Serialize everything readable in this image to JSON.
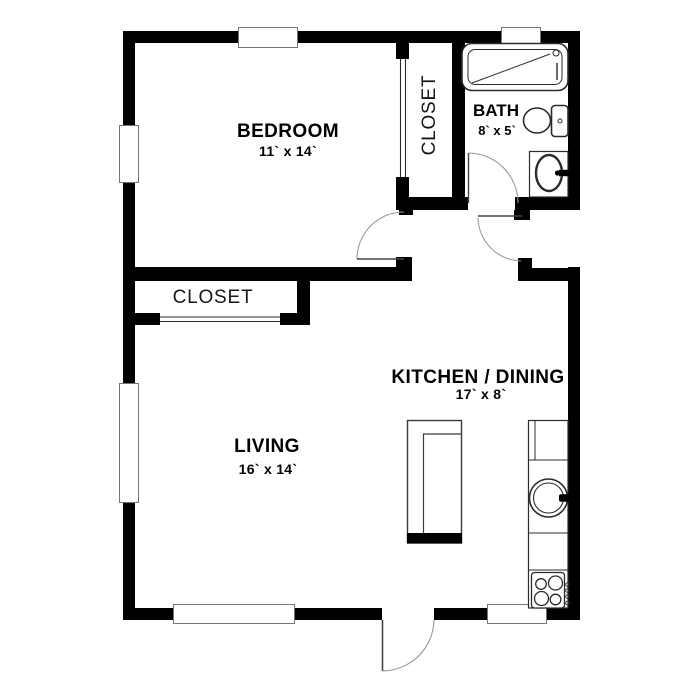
{
  "rooms": {
    "bedroom": {
      "label": "BEDROOM",
      "dims": "11` x 14`"
    },
    "closet_bedroom": {
      "label": "CLOSET"
    },
    "bath": {
      "label": "BATH",
      "dims": "8` x 5`"
    },
    "closet_living": {
      "label": "CLOSET"
    },
    "living": {
      "label": "LIVING",
      "dims": "16` x 14`"
    },
    "kitchen": {
      "label": "KITCHEN / DINING",
      "dims": "17` x 8`"
    }
  },
  "colors": {
    "wall": "#000000",
    "background": "#ffffff",
    "fixture_line": "#2b2b2b",
    "window_border": "#757575",
    "door_arc": "#9a9a9a"
  },
  "fixtures": [
    "bathtub",
    "toilet",
    "bathroom-sink",
    "kitchen-counter",
    "refrigerator",
    "kitchen-sink",
    "stove",
    "island",
    "sliding-closet-doors",
    "hinged-doors",
    "windows"
  ]
}
